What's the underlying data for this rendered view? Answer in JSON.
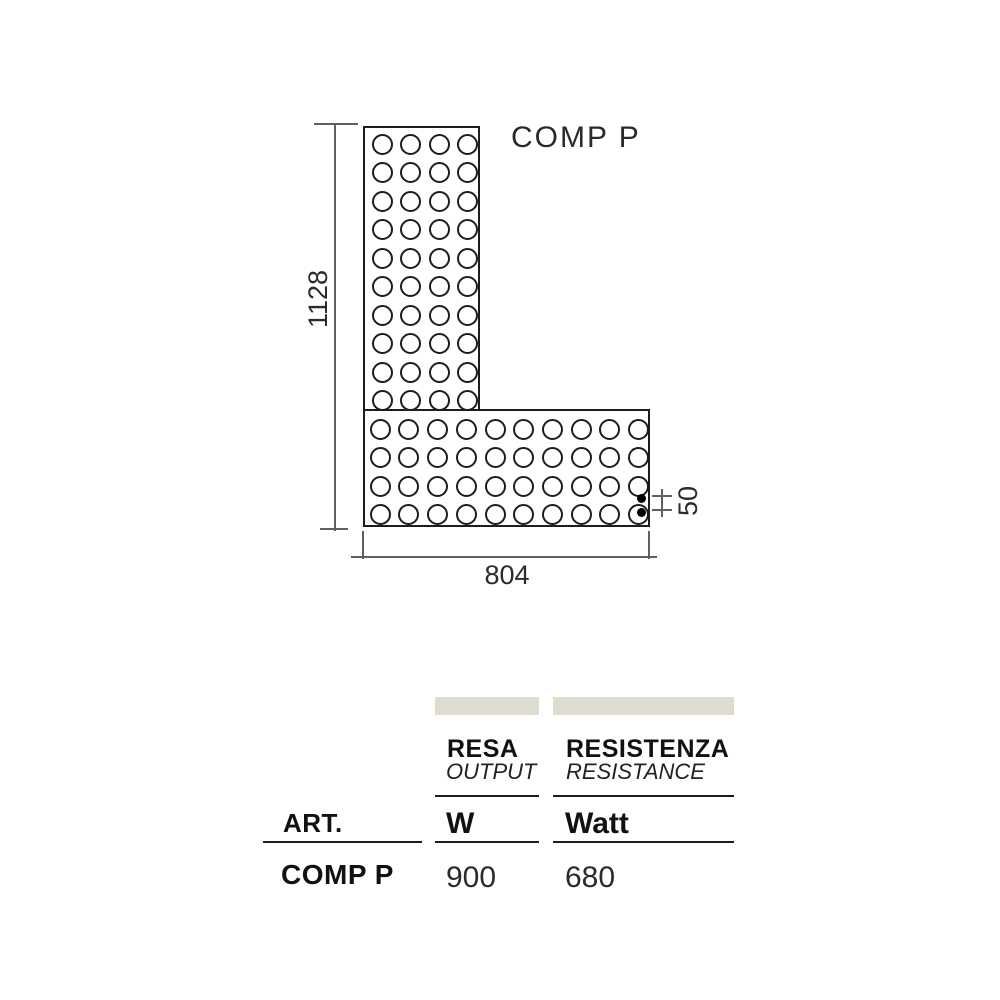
{
  "page": {
    "background": "#ffffff"
  },
  "diagram": {
    "title": "COMP P",
    "dimensions": {
      "height_mm": "1128",
      "width_mm": "804",
      "outlet_spacing_mm": "50"
    },
    "panels": {
      "vertical": {
        "columns": 4,
        "rows": 10
      },
      "horizontal": {
        "columns": 10,
        "rows": 4
      }
    },
    "connection_dots": 2,
    "line_color": "#1d1d1b"
  },
  "spec_table": {
    "art_header": "ART.",
    "columns": [
      {
        "name": "RESA",
        "name_translated": "OUTPUT",
        "unit": "W"
      },
      {
        "name": "RESISTENZA",
        "name_translated": "RESISTANCE",
        "unit": "Watt"
      }
    ],
    "row": {
      "art": "COMP P",
      "values": [
        "900",
        "680"
      ]
    },
    "bar_color": "#dedbd1"
  }
}
